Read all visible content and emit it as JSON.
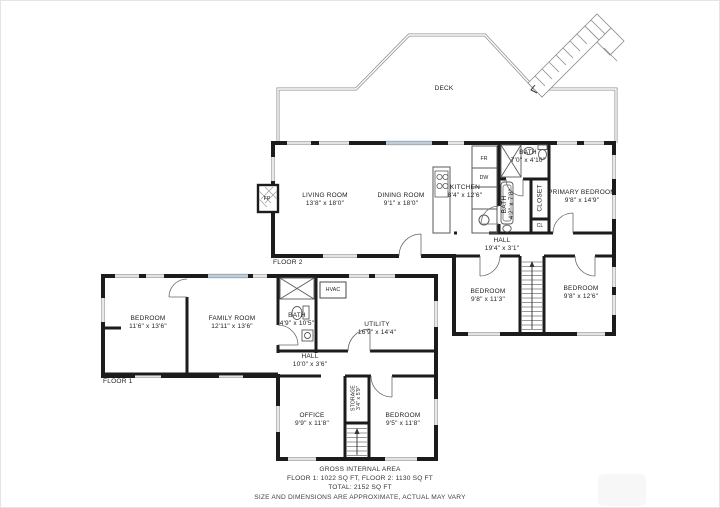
{
  "titles": {
    "deck": "DECK",
    "floor2": "FLOOR 2",
    "floor1": "FLOOR 1"
  },
  "floor2": {
    "living": {
      "name": "LIVING ROOM",
      "dims": "13'8\" x 18'0\""
    },
    "dining": {
      "name": "DINING ROOM",
      "dims": "9'1\" x 18'0\""
    },
    "kitchen": {
      "name": "KITCHEN",
      "dims": "8'4\" x 12'6\""
    },
    "bath_top": {
      "name": "BATH",
      "dims": "7'0\" x 4'10\""
    },
    "bath_side": {
      "name": "BATH",
      "dims": "4'2\" x 7'8\""
    },
    "primary": {
      "name": "PRIMARY BEDROOM",
      "dims": "9'8\" x 14'9\""
    },
    "closet": {
      "name": "CLOSET"
    },
    "cl": {
      "name": "CL"
    },
    "hall": {
      "name": "HALL",
      "dims": "19'4\" x 3'1\""
    },
    "bedroom_left": {
      "name": "BEDROOM",
      "dims": "9'8\" x 11'3\""
    },
    "bedroom_right": {
      "name": "BEDROOM",
      "dims": "9'8\" x 12'6\""
    },
    "fridge": "FR",
    "dishwasher": "DW",
    "fireplace": "FP"
  },
  "floor1": {
    "bedroom": {
      "name": "BEDROOM",
      "dims": "11'6\" x 13'6\""
    },
    "family": {
      "name": "FAMILY ROOM",
      "dims": "12'11\" x 13'6\""
    },
    "bath": {
      "name": "BATH",
      "dims": "4'9\" x 10'5\""
    },
    "hvac": {
      "name": "HVAC"
    },
    "utility": {
      "name": "UTILITY",
      "dims": "16'9\" x 14'4\""
    },
    "hall": {
      "name": "HALL",
      "dims": "10'0\" x 3'6\""
    },
    "office": {
      "name": "OFFICE",
      "dims": "9'9\" x 11'8\""
    },
    "storage": {
      "name": "STORAGE",
      "dims": "3'4\" x 5'9\""
    },
    "bedroom2": {
      "name": "BEDROOM",
      "dims": "9'5\" x 11'8\""
    }
  },
  "footer": {
    "line1": "GROSS INTERNAL AREA",
    "line2": "FLOOR 1: 1022 SQ FT, FLOOR 2: 1130 SQ FT",
    "line3": "TOTAL: 2152 SQ FT",
    "disclaimer": "SIZE AND DIMENSIONS ARE APPROXIMATE, ACTUAL MAY VARY"
  },
  "colors": {
    "wall": "#1c1c1c",
    "rail": "#909090",
    "window_glass": "#cfe3f3",
    "fixture": "#5a5a5a"
  }
}
